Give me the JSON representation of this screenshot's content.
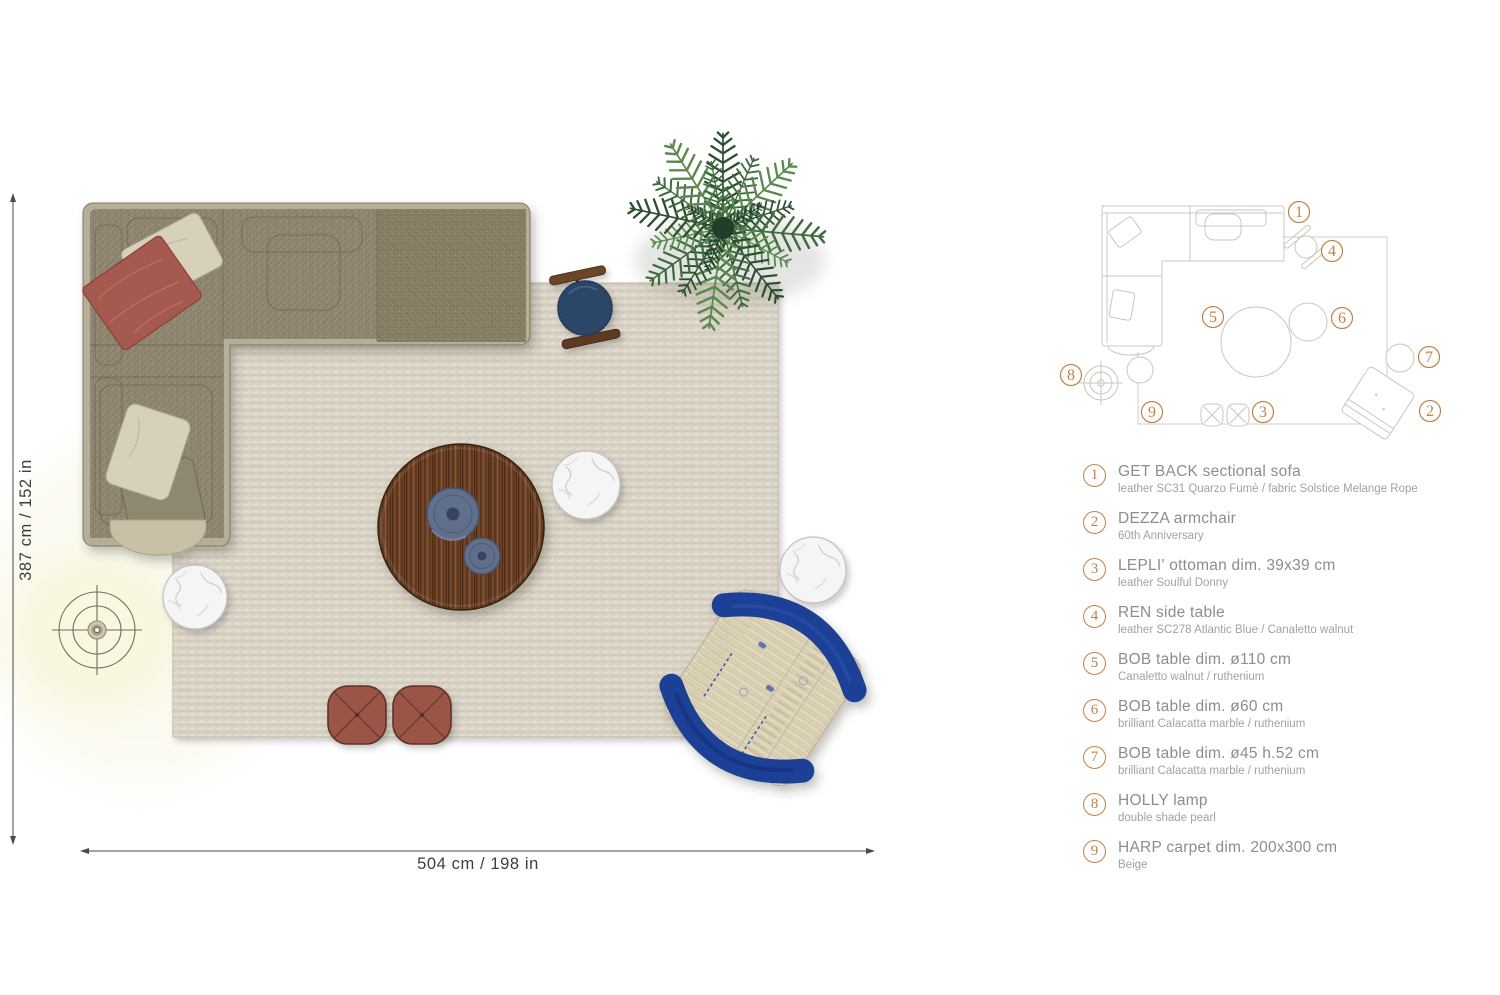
{
  "plan": {
    "dim_vertical": "387 cm / 152 in",
    "dim_horizontal": "504 cm / 198 in"
  },
  "schematic": {
    "callouts": [
      {
        "n": "1"
      },
      {
        "n": "2"
      },
      {
        "n": "3"
      },
      {
        "n": "4"
      },
      {
        "n": "5"
      },
      {
        "n": "6"
      },
      {
        "n": "7"
      },
      {
        "n": "8"
      },
      {
        "n": "9"
      }
    ]
  },
  "legend": {
    "items": [
      {
        "num": "1",
        "title": "GET BACK sectional sofa",
        "sub": "leather SC31 Quarzo Fumè / fabric Solstice Melange Rope"
      },
      {
        "num": "2",
        "title": "DEZZA armchair",
        "sub": "60th Anniversary"
      },
      {
        "num": "3",
        "title": "LEPLI' ottoman dim. 39x39 cm",
        "sub": "leather Soulful Donny"
      },
      {
        "num": "4",
        "title": "REN side table",
        "sub": "leather SC278 Atlantic Blue / Canaletto walnut"
      },
      {
        "num": "5",
        "title": "BOB table dim. ø110 cm",
        "sub": "Canaletto walnut / ruthenium"
      },
      {
        "num": "6",
        "title": "BOB table dim. ø60 cm",
        "sub": "brilliant Calacatta marble / ruthenium"
      },
      {
        "num": "7",
        "title": "BOB table dim. ø45 h.52 cm",
        "sub": "brilliant Calacatta marble / ruthenium"
      },
      {
        "num": "8",
        "title": "HOLLY lamp",
        "sub": "double shade pearl"
      },
      {
        "num": "9",
        "title": "HARP carpet dim. 200x300 cm",
        "sub": "Beige"
      }
    ]
  },
  "colors": {
    "accent_orange": "#c08243",
    "walnut": "#6e4228",
    "atlantic_blue": "#1c3f96",
    "navy_leather": "#2c4767",
    "terracotta": "#9a5547",
    "rug_beige": "#d8d2c5",
    "sofa_fabric": "#8e8671",
    "marble_white": "#f5f5f6",
    "legend_text": "#8d8d8d"
  }
}
